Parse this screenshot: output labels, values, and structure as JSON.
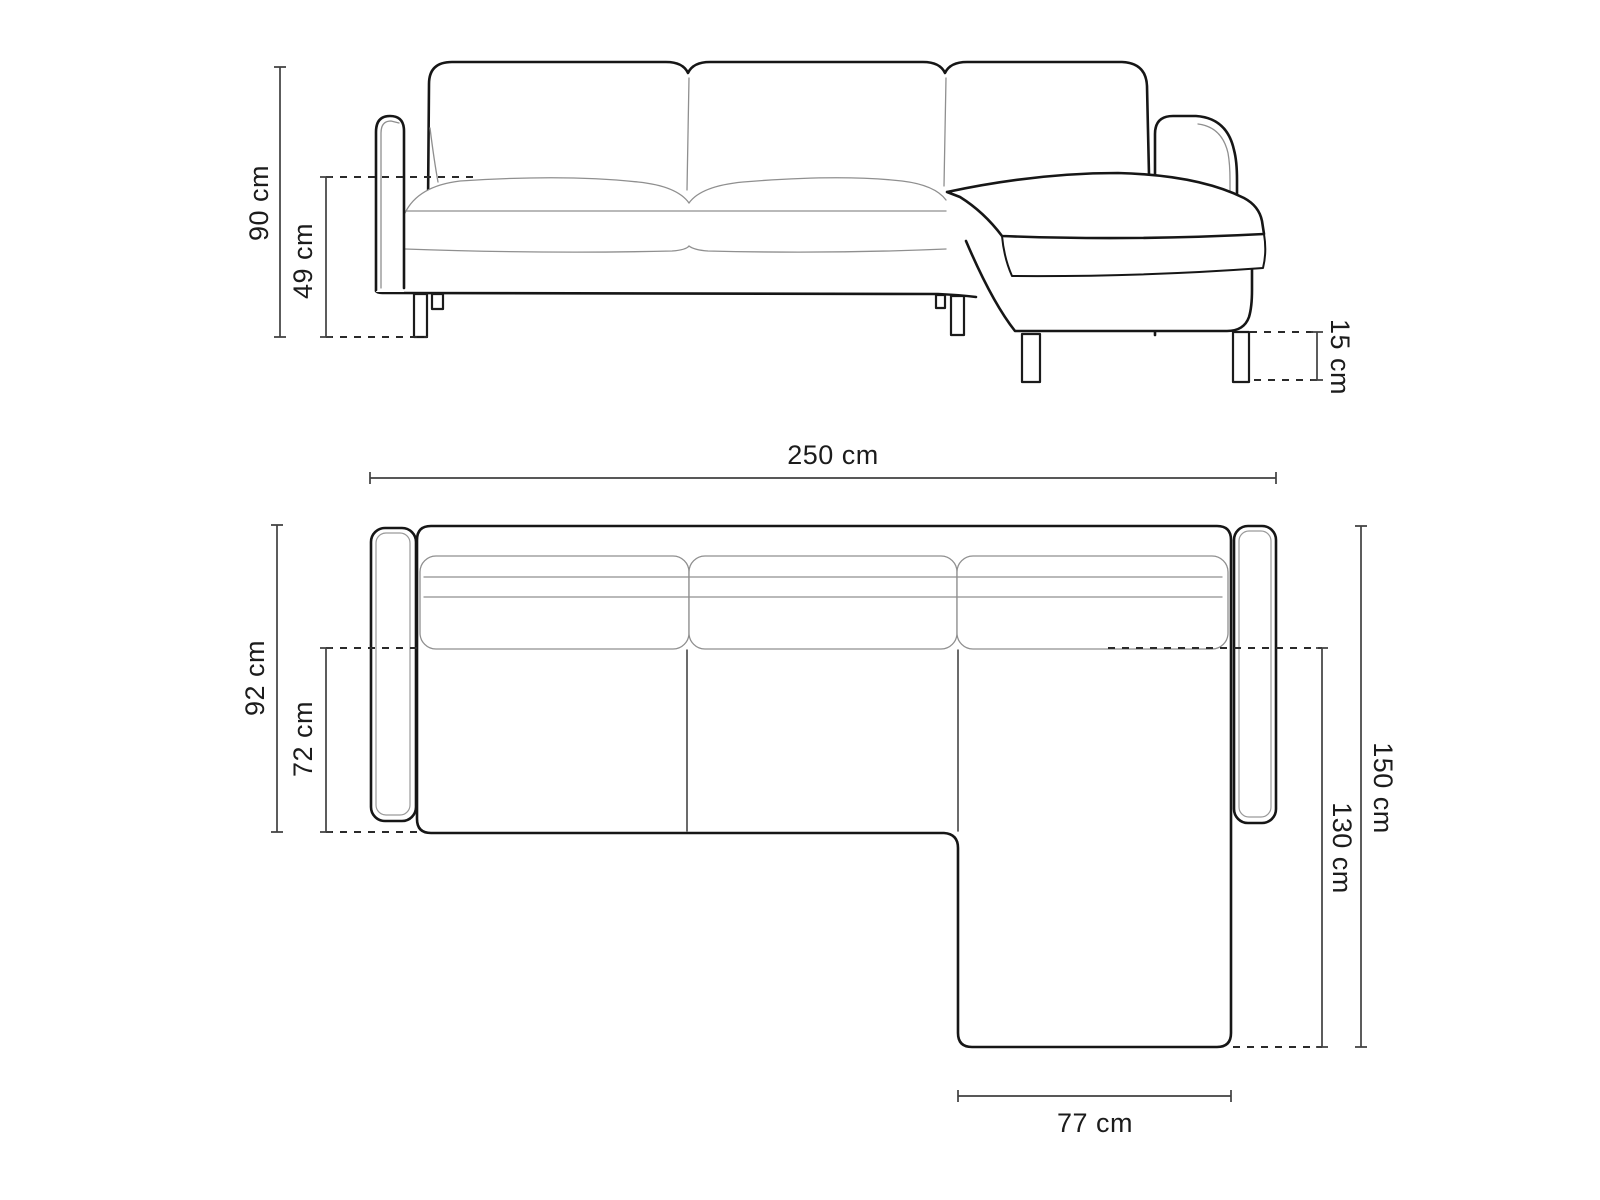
{
  "drawing": {
    "type": "sofa-dimension-diagram",
    "colors": {
      "background": "#ffffff",
      "outline": "#161616",
      "detail_line": "#8f8f8f",
      "dimension_line": "#404040",
      "label_text": "#1c1c1c"
    },
    "dimensions": {
      "total_height": {
        "label": "90 cm"
      },
      "seat_height": {
        "label": "49 cm"
      },
      "leg_height": {
        "label": "15 cm"
      },
      "total_width": {
        "label": "250 cm"
      },
      "total_depth": {
        "label": "92 cm"
      },
      "seat_depth": {
        "label": "72 cm"
      },
      "chaise_total_depth": {
        "label": "150 cm"
      },
      "chaise_length": {
        "label": "130 cm"
      },
      "chaise_width": {
        "label": "77 cm"
      }
    }
  }
}
